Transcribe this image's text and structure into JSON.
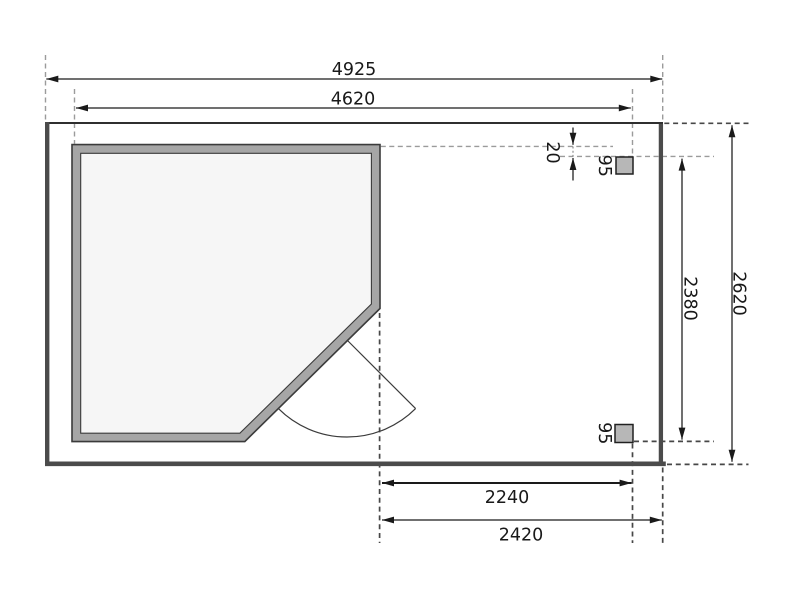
{
  "page": {
    "background": "#ffffff",
    "title": "floor-plan-drawing"
  },
  "labels": {
    "total_width": "4925",
    "house_width": "4620",
    "total_depth": "2620",
    "post_distance": "2380",
    "wall_post_offset": "20",
    "post_size_top": "95",
    "post_size_bottom": "95",
    "canopy_inner_width": "2240",
    "canopy_width": "2420"
  },
  "colors": {
    "wall_fill": "#a6a6a6",
    "room_fill": "#f6f6f6",
    "post_fill": "#b7b7b7",
    "platform_edge": "#4b4b4b",
    "platform_top_edge": "#2f2f2f",
    "dimension_line": "#1a1a1a",
    "extension_dash_light": "#9b9b9b",
    "extension_dash_dark": "#474747"
  }
}
